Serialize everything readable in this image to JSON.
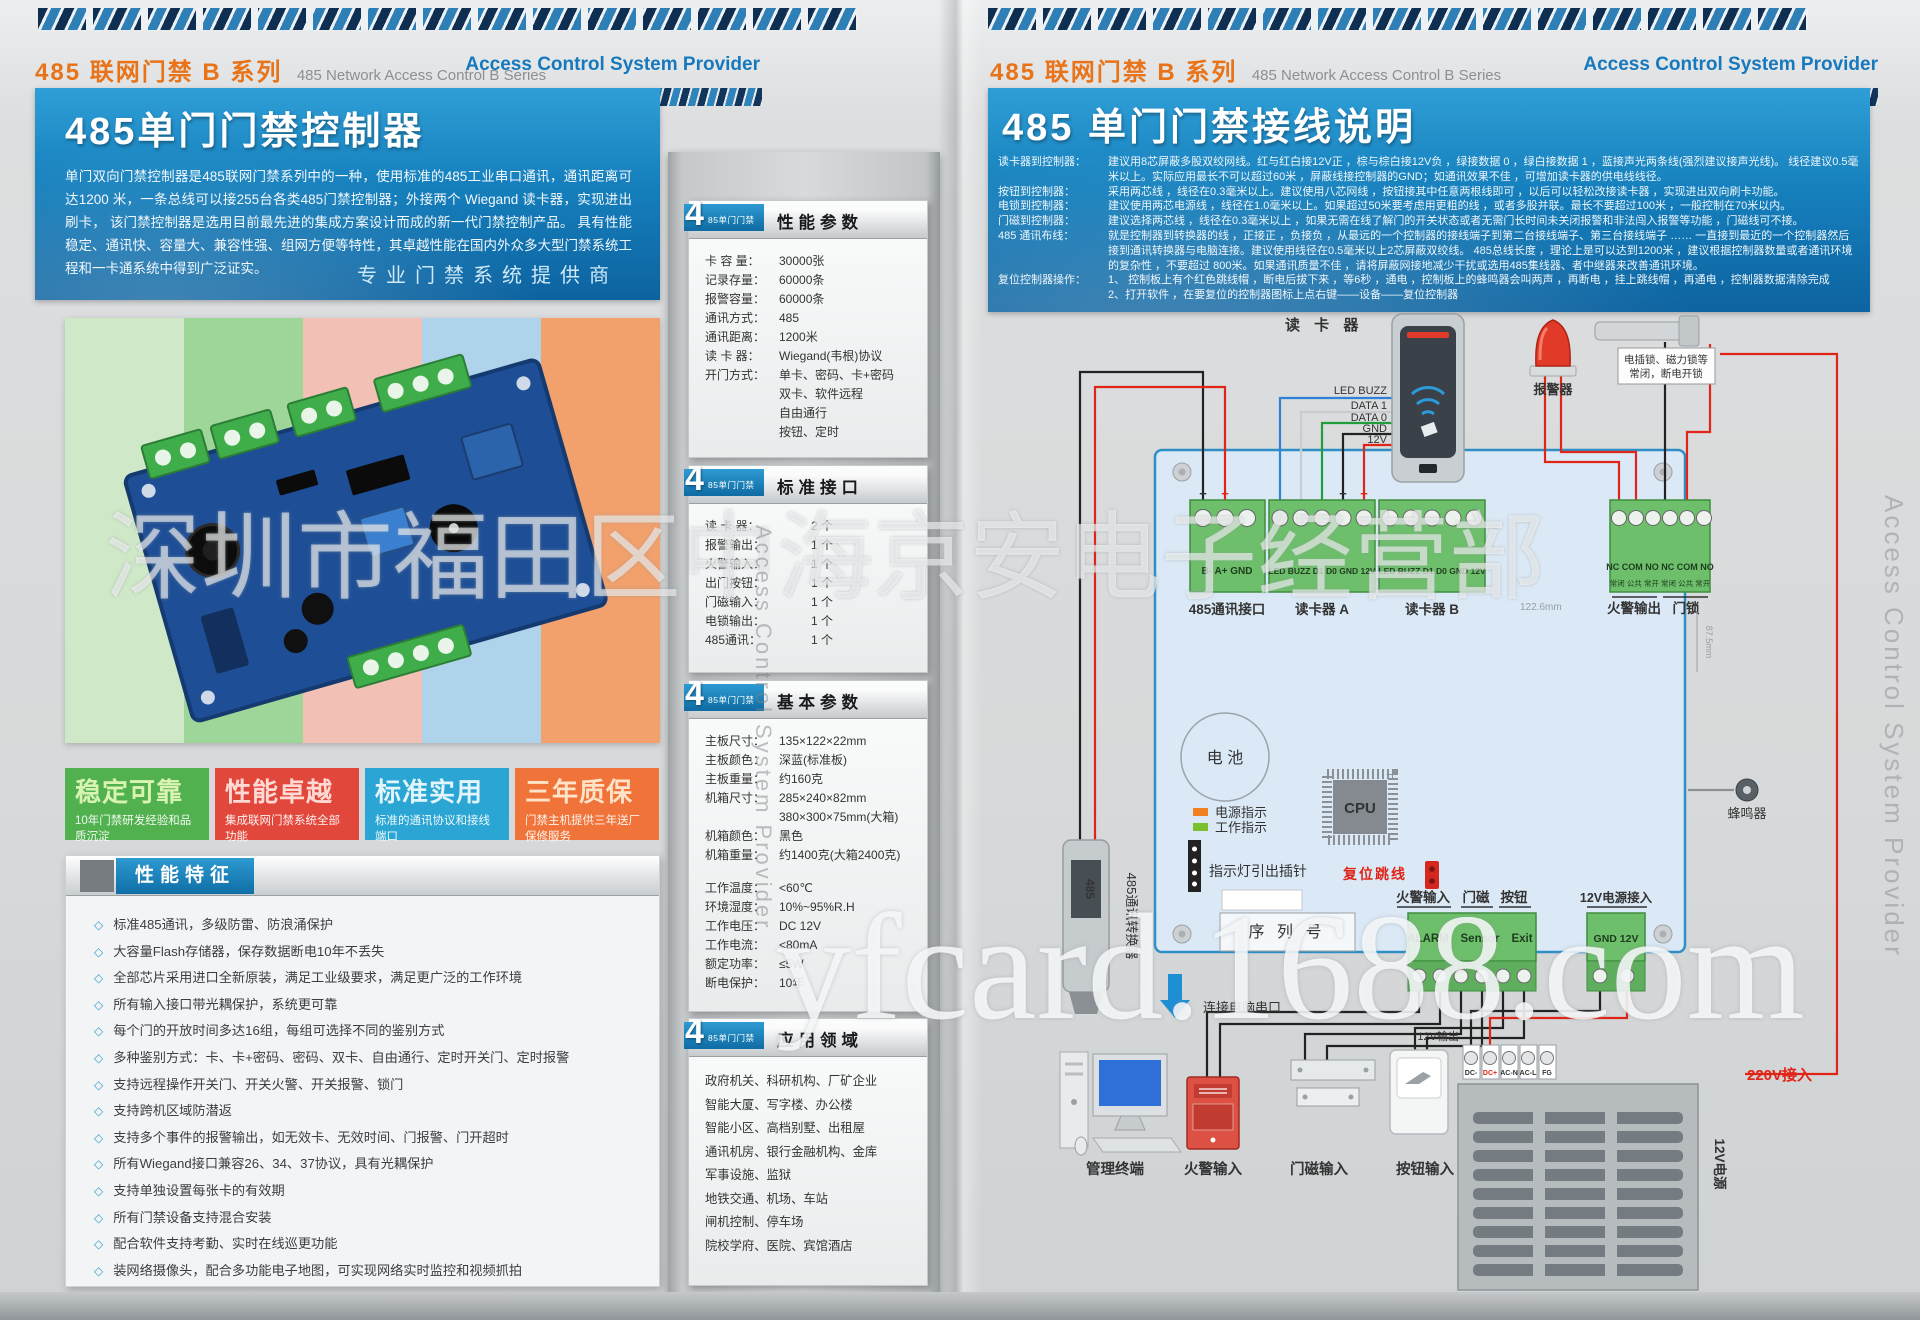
{
  "header": {
    "series_cn": "485 联网门禁 B 系列",
    "series_en": "485 Network Access Control  B  Series",
    "provider": "Access Control System Provider"
  },
  "left": {
    "hero": {
      "title": "485单门门禁控制器",
      "body": "单门双向门禁控制器是485联网门禁系列中的一种，使用标准的485工业串口通讯，通讯距离可达1200 米，一条总线可以接255台各类485门禁控制器；外接两个 Wiegand 读卡器，实现进出刷卡， 该门禁控制器是选用目前最先进的集成方案设计而成的新一代门禁控制产品。 具有性能稳定、通讯快、容量大、兼容性强、组网方便等特性，其卓越性能在国内外众多大型门禁系统工程和一卡通系统中得到广泛证实。",
      "slogan": "专业门禁系统提供商"
    },
    "selling_points": [
      {
        "title": "稳定可靠",
        "desc": "10年门禁研发经验和品质沉淀",
        "color": "#52b14f"
      },
      {
        "title": "性能卓越",
        "desc": "集成联网门禁系统全部功能",
        "color": "#e2473c"
      },
      {
        "title": "标准实用",
        "desc": "标准的通讯协议和接线端口",
        "color": "#2ba6d4"
      },
      {
        "title": "三年质保",
        "desc": "门禁主机提供三年送厂保修服务",
        "color": "#f0743a"
      }
    ],
    "features": {
      "title": "性能特征",
      "bullet": "◇",
      "items": [
        "标准485通讯，多级防雷、防浪涌保护",
        "大容量Flash存储器，保存数据断电10年不丢失",
        "全部芯片采用进口全新原装，满足工业级要求，满足更广泛的工作环境",
        "所有输入接口带光耦保护，系统更可靠",
        "每个门的开放时间多达16组，每组可选择不同的鉴别方式",
        "多种鉴别方式：卡、卡+密码、密码、双卡、自由通行、定时开关门、定时报警",
        "支持远程操作开关门、开关火警、开关报警、锁门",
        "支持跨机区域防潜返",
        "支持多个事件的报警输出，如无效卡、无效时间、门报警、门开超时",
        "所有Wiegand接口兼容26、34、37协议，具有光耦保护",
        "支持单独设置每张卡的有效期",
        "所有门禁设备支持混合安装",
        "配合软件支持考勤、实时在线巡更功能",
        "装网络摄像头，配合多功能电子地图，可实现网络实时监控和视频抓拍"
      ]
    }
  },
  "specs": {
    "tab_number": "4",
    "tab_text": "85单门门禁",
    "perf": {
      "title": "性能参数",
      "rows": [
        {
          "label": "卡 容 量：",
          "value": "30000张"
        },
        {
          "label": "记录存量：",
          "value": "60000条"
        },
        {
          "label": "报警容量：",
          "value": "60000条"
        },
        {
          "label": "通讯方式：",
          "value": "485"
        },
        {
          "label": "通讯距离：",
          "value": "1200米"
        },
        {
          "label": "读 卡 器：",
          "value": "Wiegand(韦根)协议"
        },
        {
          "label": "开门方式：",
          "value": "单卡、密码、卡+密码\n双卡、软件远程\n自由通行\n按钮、定时"
        }
      ]
    },
    "iface": {
      "title": "标准接口",
      "rows": [
        {
          "label": "读 卡 器：",
          "value": "2 个"
        },
        {
          "label": "报警输出：",
          "value": "1 个"
        },
        {
          "label": "火警输入：",
          "value": "1 个"
        },
        {
          "label": "出门按钮：",
          "value": "1 个"
        },
        {
          "label": "门磁输入：",
          "value": "1 个"
        },
        {
          "label": "电锁输出：",
          "value": "1 个"
        },
        {
          "label": "485通讯：",
          "value": "1 个"
        }
      ]
    },
    "basic": {
      "title": "基本参数",
      "rows1": [
        {
          "label": "主板尺寸：",
          "value": "135×122×22mm"
        },
        {
          "label": "主板颜色：",
          "value": "深蓝(标准板)"
        },
        {
          "label": "主板重量：",
          "value": "约160克"
        },
        {
          "label": "机箱尺寸：",
          "value": "285×240×82mm\n380×300×75mm(大箱)"
        },
        {
          "label": "机箱颜色：",
          "value": "黑色"
        },
        {
          "label": "机箱重量：",
          "value": "约1400克(大箱2400克)"
        }
      ],
      "rows2": [
        {
          "label": "工作温度：",
          "value": "<60℃"
        },
        {
          "label": "环境湿度：",
          "value": "10%~95%R.H"
        },
        {
          "label": "工作电压：",
          "value": "DC 12V"
        },
        {
          "label": "工作电流：",
          "value": "<80mA"
        },
        {
          "label": "额定功率：",
          "value": "≤5W"
        },
        {
          "label": "断电保护：",
          "value": "10年"
        }
      ]
    },
    "apps": {
      "title": "应用领域",
      "lines": [
        "政府机关、科研机构、厂矿企业",
        "智能大厦、写字楼、办公楼",
        "智能小区、高档别墅、出租屋",
        "通讯机房、银行金融机构、金库",
        "军事设施、监狱",
        "地铁交通、机场、车站",
        "闸机控制、停车场",
        "院校学府、医院、宾馆酒店"
      ]
    }
  },
  "right": {
    "hero": {
      "title": "485 单门门禁接线说明",
      "notes": [
        {
          "label": "读卡器到控制器：",
          "text": "建议用8芯屏蔽多股双绞网线。红与红白接12V正 ，棕与棕白接12V负 ，绿接数据 0 ，绿白接数据 1 ，蓝接声光两条线(强烈建议接声光线)。 线径建议0.5毫米以上。实际应用最长不可以超过60米 ，屏蔽线接控制器的GND；如通讯效果不佳 ，可增加读卡器的供电线线径。"
        },
        {
          "label": "按钮到控制器：",
          "text": "采用两芯线 ，线径在0.3毫米以上。建议使用八芯网线 ，按钮接其中任意两根线即可 ，以后可以轻松改接读卡器 ，实现进出双向刷卡功能。"
        },
        {
          "label": "电锁到控制器：",
          "text": "建议使用两芯电源线 ，线径在1.0毫米以上。如果超过50米要考虑用更粗的线 ，或者多股并联。最长不要超过100米 ，一般控制在70米以内。"
        },
        {
          "label": "门磁到控制器：",
          "text": "建议选择两芯线 ，线径在0.3毫米以上 ，如果无需在线了解门的开关状态或者无需门长时间未关闭报警和非法闯入报警等功能 ，门磁线可不接。"
        },
        {
          "label": "485 通讯布线：",
          "text": "就是控制器到转换器的线 ，正接正 ，负接负 ，从最远的一个控制器的接线端子到第二台接线端子、第三台接线端子 …… 一直接到最近的一个控制器然后接到通讯转换器与电脑连接。建议使用线径在0.5毫米以上2芯屏蔽双绞线。 485总线长度 ，理论上是可以达到1200米 ，建议根据控制器数量或者通讯环境的复杂性 ，不要超过 800米。如果通讯质量不佳 ，请将屏蔽网接地减少干扰或选用485集线器、者中继器来改善通讯环境。"
        },
        {
          "label": "复位控制器操作：",
          "text": "1、 控制板上有个红色跳线帽 ，断电后拔下来 ，等6秒 ，通电 ，控制板上的蜂鸣器会叫两声 ，再断电 ，挂上跳线帽 ，再通电 ，控制器数据清除完成\n2、打开软件 ，在要复位的控制器图标上点右键——设备——复位控制器"
        }
      ]
    },
    "diagram": {
      "reader_title": "读 卡 器",
      "reader_pin_0": "LED BUZZ",
      "reader_pin_1": "DATA 1",
      "reader_pin_2": "DATA 0",
      "reader_pin_3": "GND",
      "reader_pin_4": "12V",
      "alarm_device": "报警器",
      "lock_note1": "电插锁、磁力锁等",
      "lock_note2": "常闭，断电开锁",
      "tb485_pins": "B-    A+   GND",
      "tb485_label": "485通讯接口",
      "reader_block_pins": "LED BUZZ  D1   D0  GND 12V",
      "readerA_label": "读卡器 A",
      "readerB_label": "读卡器 B",
      "relay_pins": "NC COM NO NC COM NO",
      "relay_pins_cn": "常闭 公共 常开 常闭 公共 常开",
      "fire_out_label": "火警输出",
      "lock_label": "门锁",
      "dim_width": "122.6mm",
      "dim_height": "87.5mm",
      "battery": "电 池",
      "cpu": "CPU",
      "led_power": "电源指示",
      "led_work": "工作指示",
      "pin_header": "指示灯引出插针",
      "reset_jumper": "复位跳线",
      "serial_no": "序 列 号",
      "buzzer": "蜂鸣器",
      "fire_in": "火警输入",
      "door_contact": "门磁",
      "button": "按钮",
      "alarm_pin1": "ALARM",
      "alarm_pin2": "Sensor",
      "alarm_pin3": "Exit",
      "psu_in": "12V电源接入",
      "gnd12v": "GND 12V",
      "converter": "485通讯转换器",
      "converter_text": "485",
      "serial_port": "连接电脑串口",
      "pc": "管理终端",
      "fire_dev": "火警输入",
      "magnet_dev": "门磁输入",
      "button_dev": "按钮输入",
      "out12v": "12V输出",
      "psu_t1": "DC-",
      "psu_t2": "DC+",
      "psu_t3": "AC-N",
      "psu_t4": "AC-L",
      "psu_t5": "FG",
      "ac220": "220V接入",
      "psu_side": "12V电源",
      "plus": "+",
      "minus": "−"
    }
  },
  "watermarks": {
    "center": "深圳市福田区中海京安电子经营部",
    "bottom": "yfcard.1688.com",
    "side": "Access Control System Provider"
  }
}
